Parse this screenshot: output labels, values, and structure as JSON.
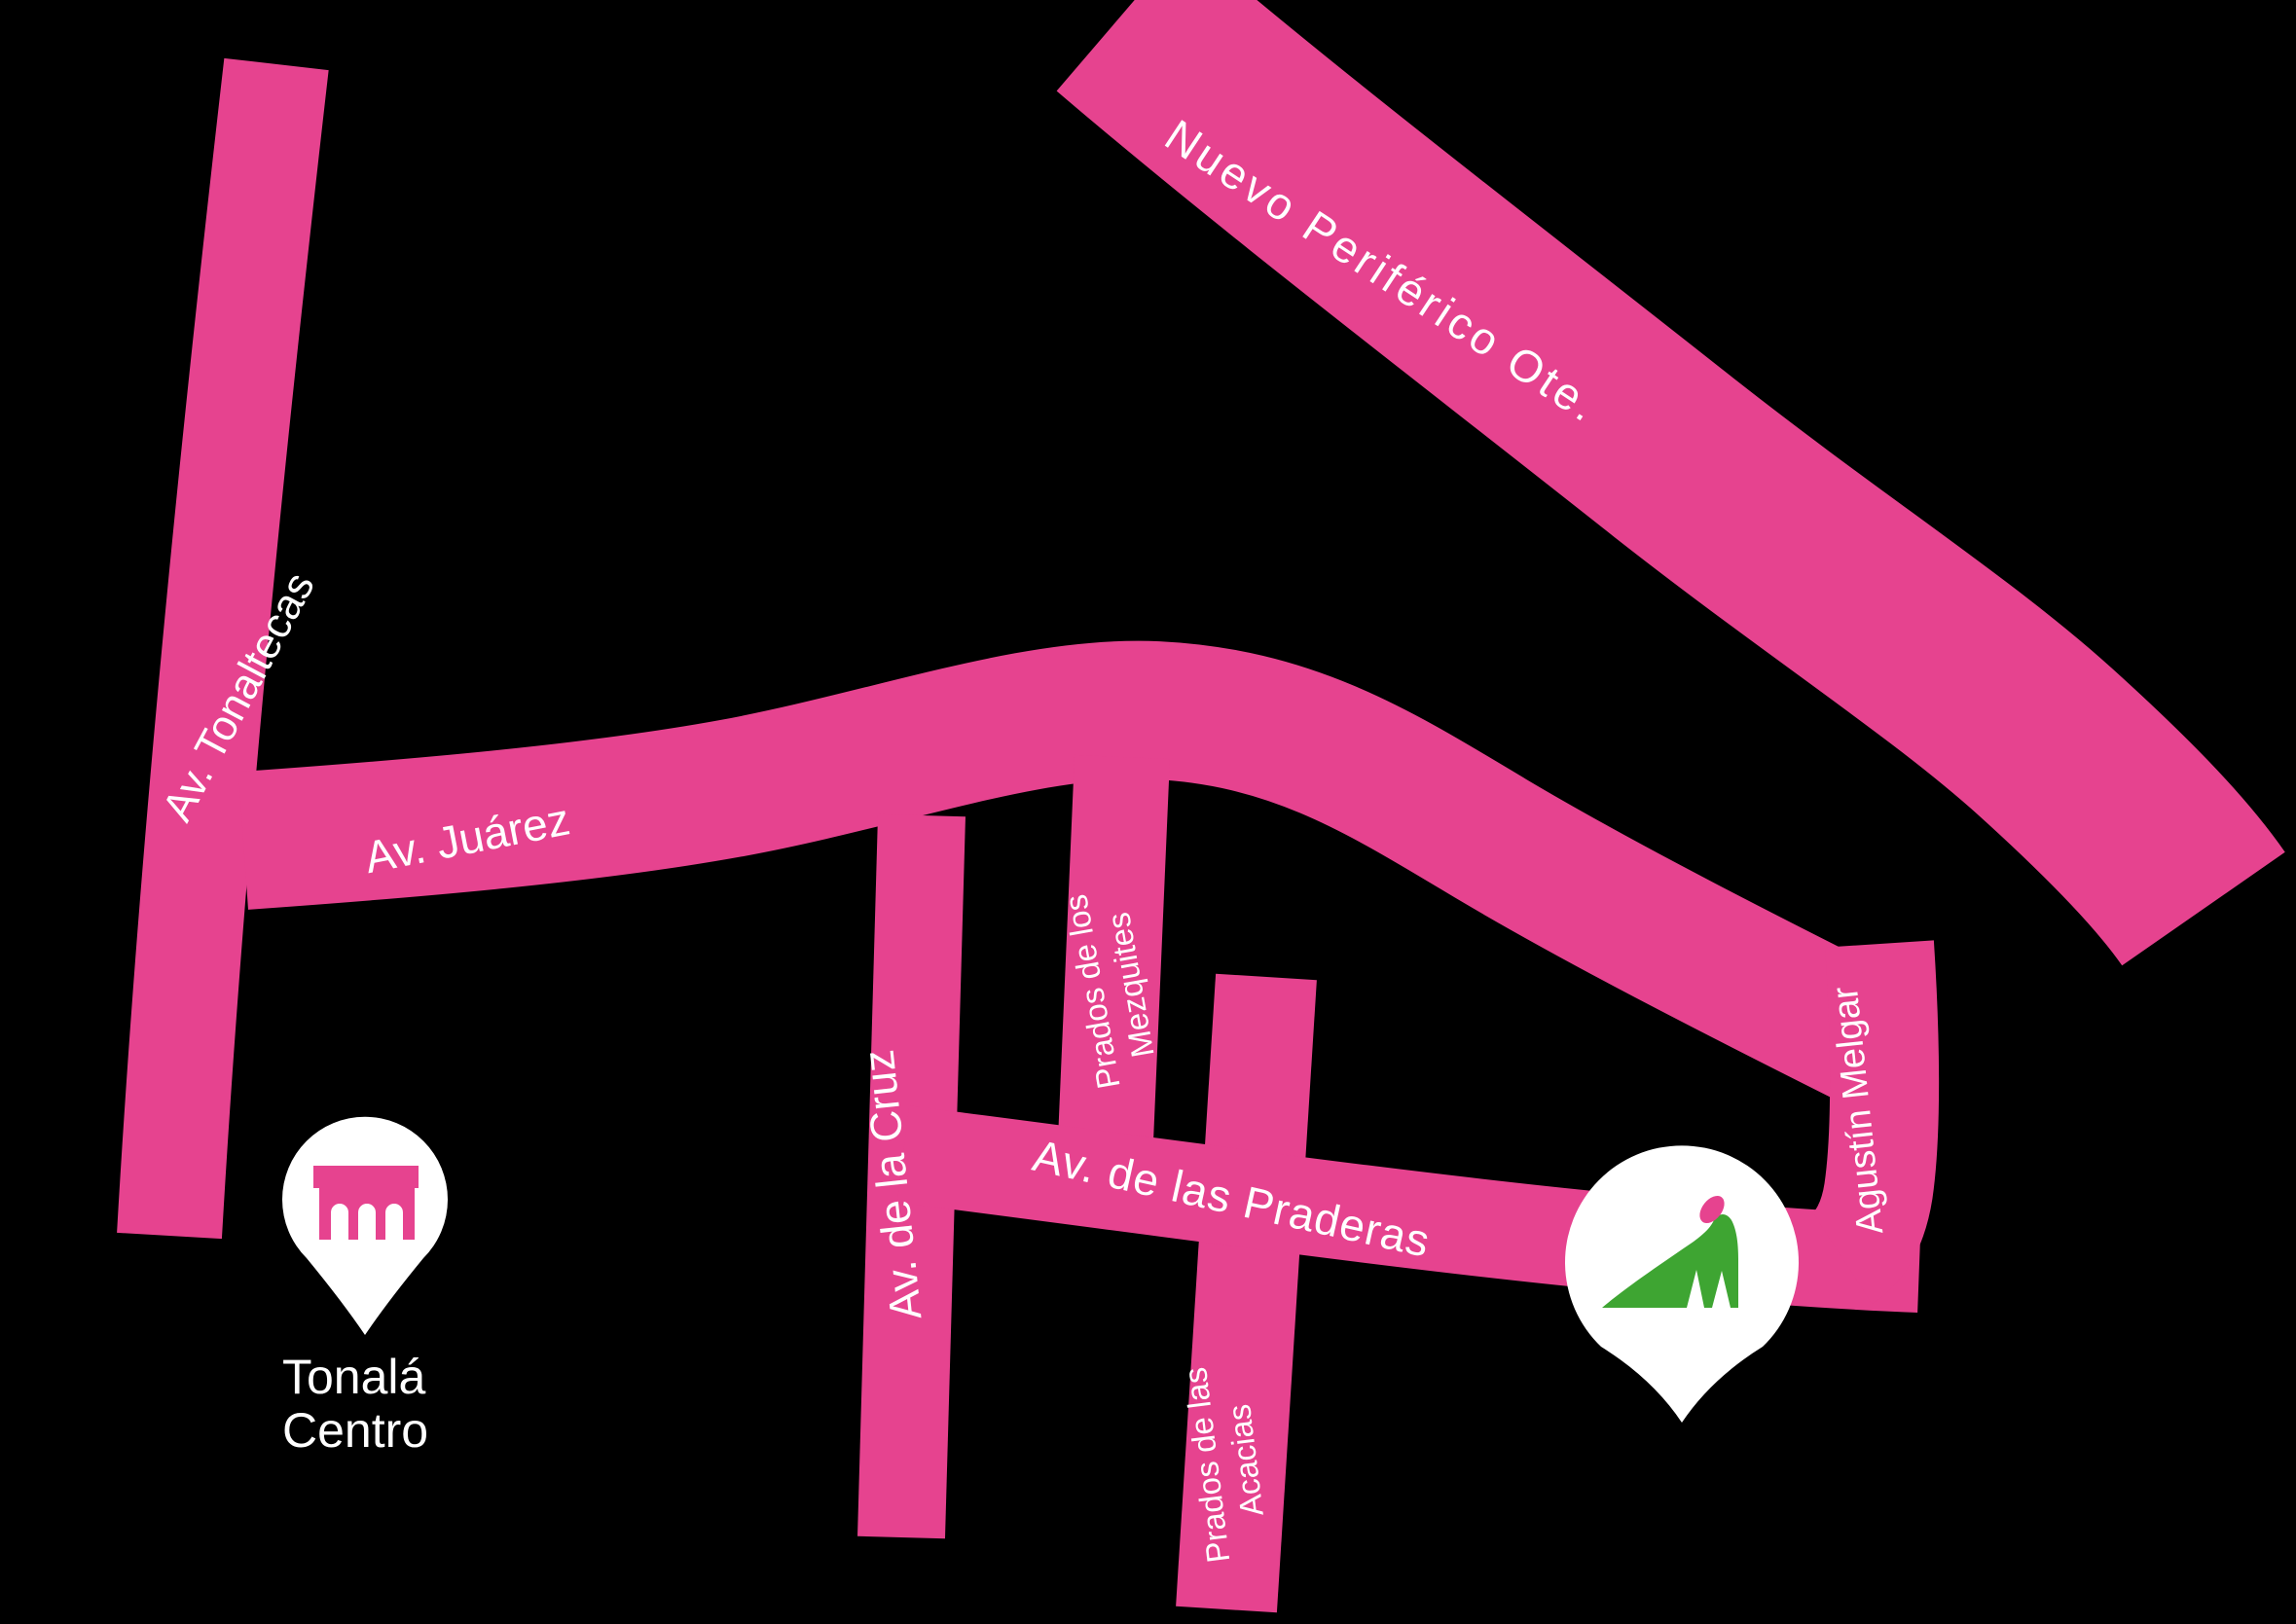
{
  "map": {
    "background_color": "#000000",
    "road_color": "#e6438f",
    "label_color": "#ffffff",
    "pin_color": "#ffffff"
  },
  "roads": {
    "tonaltecas": {
      "label": "Av. Tonaltecas"
    },
    "juarez": {
      "label": "Av. Juárez"
    },
    "periferico": {
      "label": "Nuevo Periférico Ote."
    },
    "cruz": {
      "label": "Av. de la Cruz"
    },
    "mezquites": {
      "label_line1": "Prados de los",
      "label_line2": "Mezquites"
    },
    "praderas": {
      "label": "Av. de las Praderas"
    },
    "acacias": {
      "label_line1": "Prados de las",
      "label_line2": "Acacias"
    },
    "melgar": {
      "label": "Agustín Melgar"
    }
  },
  "markers": {
    "tonala_centro": {
      "label_line1": "Tonalá",
      "label_line2": "Centro",
      "icon": "bridge-icon",
      "icon_color": "#e6438f"
    },
    "destination": {
      "icon": "iguana-icon",
      "body_color": "#3ea532",
      "crest_color": "#e6438f"
    }
  }
}
